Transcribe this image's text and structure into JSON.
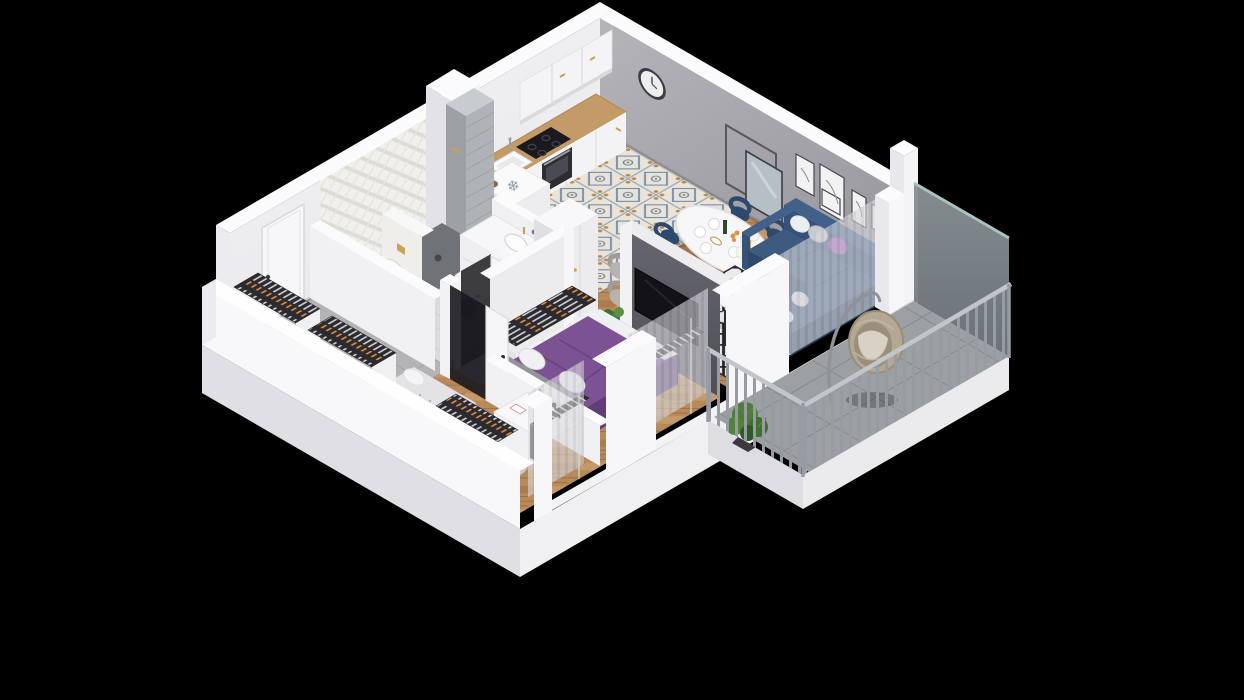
{
  "scene": {
    "type": "isometric-floor-plan",
    "description": "3D cutaway dollhouse rendering of a one-bedroom apartment with balcony, shown on a black background",
    "fridge_symbol": "❄"
  },
  "rooms": [
    {
      "name": "Kitchen",
      "furniture": [
        "white upper cabinets",
        "white base cabinets",
        "wooden countertop",
        "black cooktop",
        "oven",
        "sink",
        "fridge cabinet with snowflake mark",
        "patterned blue tile floor"
      ]
    },
    {
      "name": "Dining area",
      "furniture": [
        "oval white pedestal table",
        "navy chairs with gold legs",
        "plates and bottle",
        "orange flowers",
        "gold floor lamp with white globes",
        "two gray armchairs",
        "pouf"
      ]
    },
    {
      "name": "Living room",
      "furniture": [
        "navy corner sofa",
        "white gray and purple pillows",
        "black and white diamond rug",
        "round white coffee table with purple vase",
        "TV on dark partition wall",
        "wall clock",
        "leaning mirror and frame",
        "art frames",
        "sheer curtains",
        "radiator"
      ]
    },
    {
      "name": "Master bedroom",
      "furniture": [
        "double bed with purple duvet",
        "white pillows",
        "gray headboard",
        "built-in wardrobe with hanging clothes",
        "radiator",
        "window curtain"
      ]
    },
    {
      "name": "Kids bedroom",
      "furniture": [
        "single bed with gray bedding",
        "speckled gray rug",
        "white desk with plant and lamp",
        "purple chair",
        "wardrobe rack with clothes",
        "radiator",
        "window curtain"
      ]
    },
    {
      "name": "Bathroom",
      "furniture": [
        "walk-in shower with dark floor",
        "wall-hung toilet with gold flush plate",
        "white vanity with basin and flowers",
        "washing machine",
        "white herringbone tiled wall",
        "gray service column"
      ]
    },
    {
      "name": "Hallway",
      "furniture": [
        "white entrance door",
        "open wardrobes with hanging clothes",
        "tall white cabinet",
        "gray tile floor",
        "bathroom door"
      ]
    },
    {
      "name": "Balcony",
      "furniture": [
        "hanging rattan egg chair",
        "green plants",
        "vertical bar metal railing",
        "gray privacy glass panel",
        "gray tile floor"
      ]
    }
  ],
  "colors": {
    "bg": "#000000",
    "wall": "#f2f2f4",
    "wall_top": "#fbfbfd",
    "wall_shade": "#e2e2e7",
    "wall_gray": "#a6a6ab",
    "wall_dark": "#5c5c63",
    "wood": "#b9895a",
    "counter": "#c49a66",
    "tile_kitchen": "#e9e4d8",
    "tile_motif": "#7089ad",
    "tile_gray": "#b3b4b6",
    "tile_bath": "#dadbdd",
    "tile_balcony": "#9da0a2",
    "shower": "#6f7276",
    "sofa": "#3c5b7e",
    "sofa_dark": "#2f4a68",
    "purple": "#7d5295",
    "purple_bright": "#9b59b6",
    "rug": "#ebebeb",
    "rug_line": "#232327",
    "rack": "#2b2b2f",
    "orange": "#de9045",
    "gold": "#c9a25a",
    "plant": "#4d7d3c",
    "rattan": "#b5a893",
    "cushion": "#d8d1c4",
    "curtain": "#dadade",
    "radiator": "#2a2a2e",
    "tv": "#121217",
    "glass": "#80878c",
    "rail": "#969ca1"
  }
}
